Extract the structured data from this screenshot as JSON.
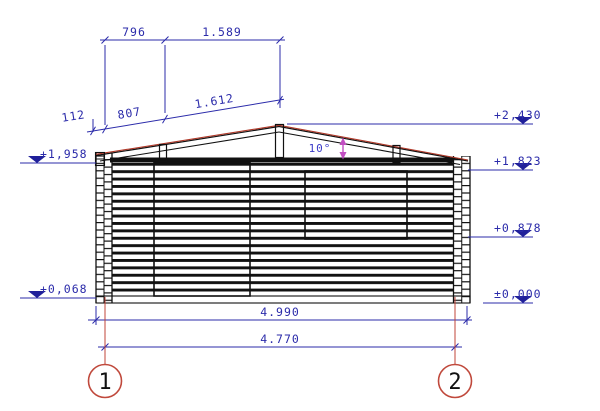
{
  "drawing": {
    "grid_bubbles": [
      {
        "label": "1"
      },
      {
        "label": "2"
      }
    ],
    "roof": {
      "angle": "10°"
    },
    "dimensions": {
      "top": [
        {
          "label": "796"
        },
        {
          "label": "1.589"
        }
      ],
      "slope": [
        {
          "label": "112"
        },
        {
          "label": "807"
        },
        {
          "label": "1.612"
        }
      ],
      "bottom": [
        {
          "label": "4.990"
        },
        {
          "label": "4.770"
        }
      ]
    },
    "elevation_markers": {
      "left": [
        {
          "label": "+1,958"
        },
        {
          "label": "+0,068"
        }
      ],
      "right": [
        {
          "label": "+2,430"
        },
        {
          "label": "+1,823"
        },
        {
          "label": "+0,878"
        },
        {
          "label": "±0,000"
        }
      ]
    },
    "colors": {
      "dimension_blue": "#2b2baa",
      "marker_blue": "#20209a",
      "grid_red": "#c04438",
      "roof_edge_red": "#b03828",
      "angle_arrow_magenta": "#c24ec2",
      "line_black": "#111111"
    }
  }
}
